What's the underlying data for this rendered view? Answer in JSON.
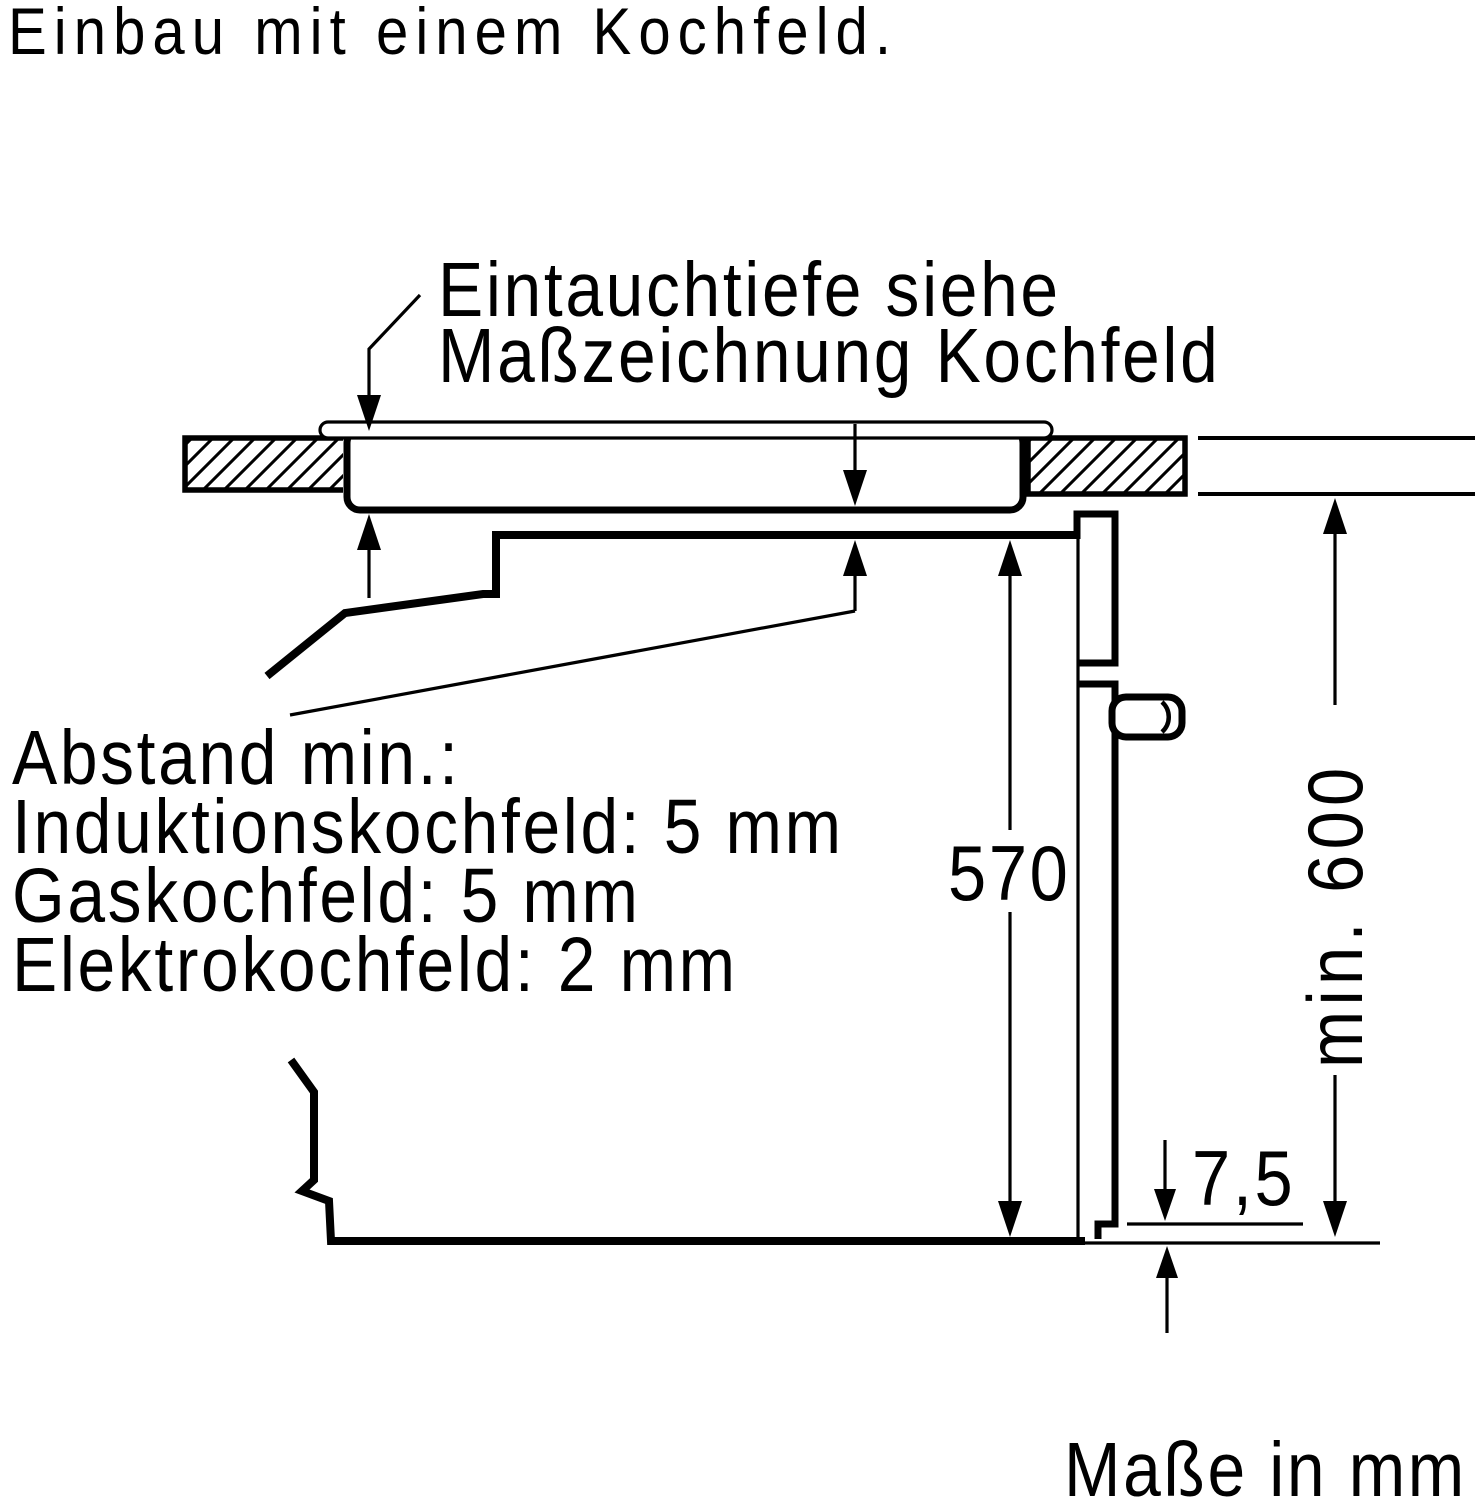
{
  "title": "Einbau mit einem Kochfeld.",
  "callout": {
    "line1": "Eintauchtiefe siehe",
    "line2": "Maßzeichnung Kochfeld"
  },
  "clearances": {
    "heading": "Abstand min.:",
    "items": [
      "Induktionskochfeld: 5 mm",
      "Gaskochfeld: 5 mm",
      "Elektrokochfeld: 2 mm"
    ]
  },
  "dimensions": {
    "oven_interior_height": "570",
    "niche_height": "min. 600",
    "door_bottom_gap": "7,5"
  },
  "footer": "Maße in mm",
  "colors": {
    "ink": "#000000",
    "background": "#ffffff"
  }
}
